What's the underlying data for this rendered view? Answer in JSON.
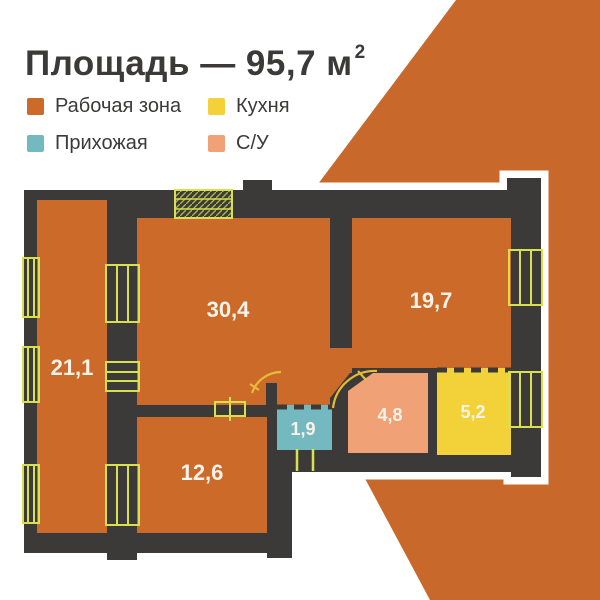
{
  "title": {
    "main": "Площадь — 95,7 м",
    "superscript": "2",
    "total_area_m2": "95,7"
  },
  "legend": [
    {
      "label": "Рабочая зона",
      "color": "#cb6a29"
    },
    {
      "label": "Кухня",
      "color": "#f2d238"
    },
    {
      "label": "Прихожая",
      "color": "#74b9bf"
    },
    {
      "label": "С/У",
      "color": "#f0a276"
    }
  ],
  "floorplan": {
    "rooms": [
      {
        "area": "21,1",
        "zone": "Рабочая зона"
      },
      {
        "area": "30,4",
        "zone": "Рабочая зона"
      },
      {
        "area": "19,7",
        "zone": "Рабочая зона"
      },
      {
        "area": "12,6",
        "zone": "Рабочая зона"
      },
      {
        "area": "1,9",
        "zone": "Прихожая"
      },
      {
        "area": "4,8",
        "zone": "С/У"
      },
      {
        "area": "5,2",
        "zone": "Кухня"
      }
    ],
    "colors": {
      "work_zone": "#cb6a29",
      "kitchen": "#f2d238",
      "hallway": "#74b9bf",
      "bathroom": "#f0a276",
      "walls": "#3b3a39",
      "background_accent": "#c8682b",
      "window_symbol": "#d9e04f",
      "hatch": "#a9b24b",
      "door_arc": "#e7ba38",
      "background": "#ffffff"
    }
  }
}
